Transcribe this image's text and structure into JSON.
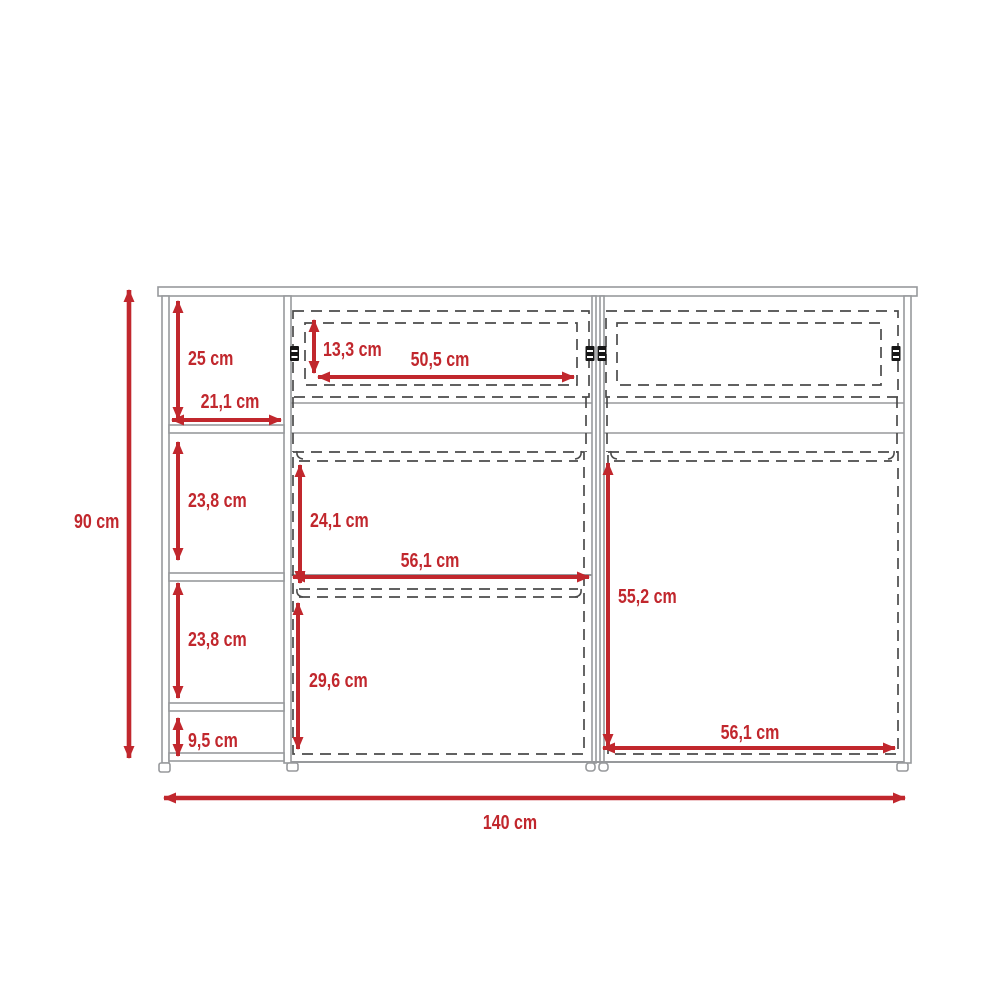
{
  "page": {
    "background": "#ffffff"
  },
  "colors": {
    "dim": "#c1272d",
    "structure": "#97999c",
    "dashed": "#4b4b4b",
    "hinge": "#161616"
  },
  "icons": {
    "hinge": "hinge-icon",
    "shelf_pin": "shelf-pin-icon",
    "foot": "foot-icon"
  },
  "diagram": {
    "type": "furniture-dimension-drawing",
    "unit": "cm",
    "overall": {
      "height": "90 cm",
      "width": "140 cm"
    },
    "left_shelf_unit": {
      "top_section_height": "25 cm",
      "shelf_depth": "21,1 cm",
      "middle_section_height": "23,8 cm",
      "lower_section_height": "23,8 cm",
      "base_height": "9,5 cm"
    },
    "top_doors": {
      "opening_height": "13,3 cm",
      "opening_width": "50,5 cm"
    },
    "left_compartment": {
      "upper_height": "24,1 cm",
      "width": "56,1 cm",
      "lower_height": "29,6 cm"
    },
    "right_compartment": {
      "height": "55,2 cm",
      "width": "56,1 cm"
    }
  }
}
